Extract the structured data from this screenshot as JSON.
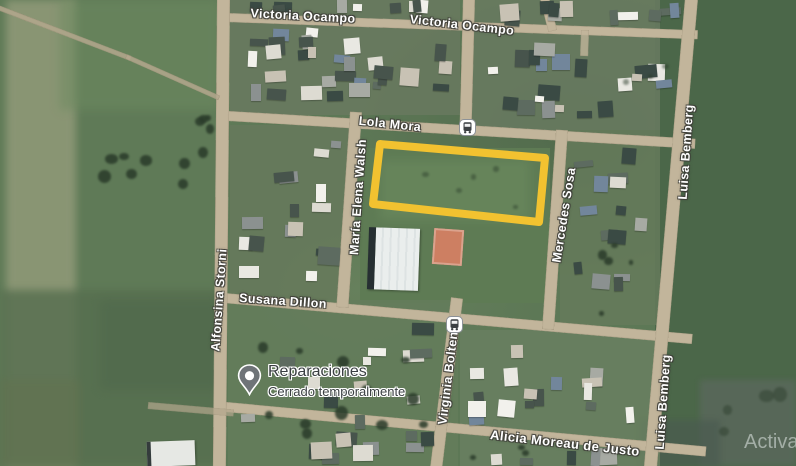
{
  "map": {
    "streets": {
      "victoria_ocampo_west": "Victoria Ocampo",
      "victoria_ocampo_east": "Victoria Ocampo",
      "lola_mora": "Lola Mora",
      "maria_elena_walsh": "María Elena Walsh",
      "mercedes_sosa": "Mercedes Sosa",
      "luisa_bemberg_north": "Luisa Bemberg",
      "luisa_bemberg_south": "Luisa Bemberg",
      "alfonsina_storni": "Alfonsina Storni",
      "susana_dillon": "Susana Dillon",
      "virginia_bolten": "Virginia Bolten",
      "alicia_moreau_de_justo": "Alicia Moreau de Justo"
    },
    "poi": {
      "name": "Reparaciones",
      "status": "Cerrado temporalmente"
    },
    "icons": {
      "transit": "bus-icon",
      "poi": "map-pin-icon"
    },
    "highlight": {
      "color": "#F2C230"
    }
  },
  "watermark": {
    "text": "Activa"
  }
}
